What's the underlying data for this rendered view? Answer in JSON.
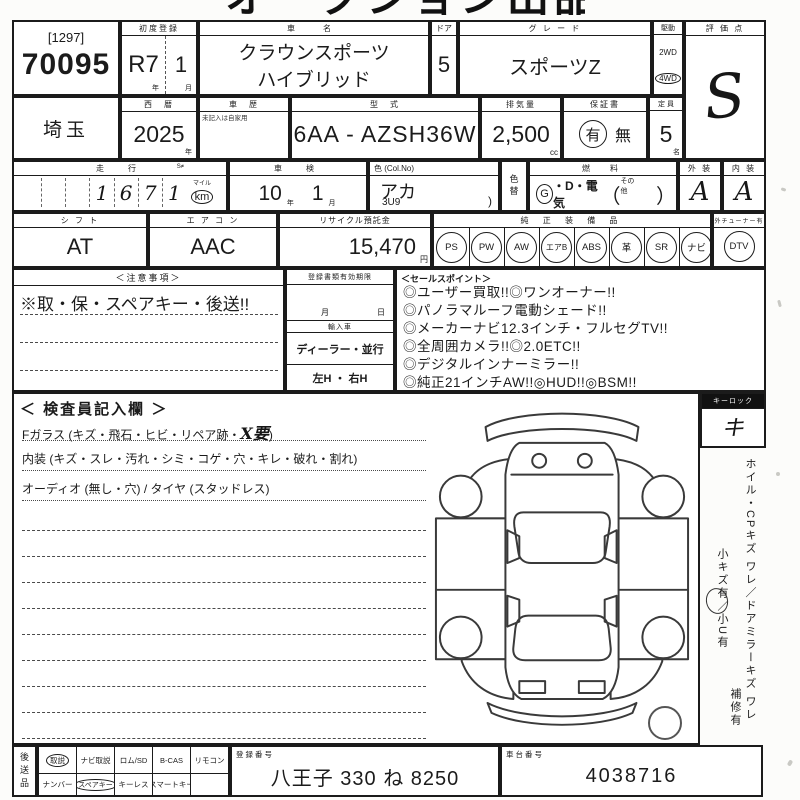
{
  "page": {
    "cropped_title": "オークション出品票"
  },
  "header": {
    "auction_bracket": "[1297]",
    "auction_no": "70095",
    "first_reg": {
      "label": "初度登録",
      "year": "R7",
      "year_suffix": "年",
      "month": "1",
      "month_suffix": "月"
    },
    "car_name": {
      "label": "車　名",
      "line1": "クラウンスポーツ",
      "line2": "ハイブリッド"
    },
    "door": {
      "label": "ドア",
      "value": "5"
    },
    "grade": {
      "label": "グ レ ー ド",
      "value": "スポーツZ"
    },
    "drive": {
      "label": "駆動",
      "opt_2wd": "2WD",
      "opt_4wd": "4WD",
      "selected": "4WD"
    },
    "score": {
      "label": "評 価 点",
      "value": "S"
    }
  },
  "row2": {
    "prefecture": "埼玉",
    "year": {
      "label": "西　暦",
      "value": "2025",
      "suffix": "年"
    },
    "history": {
      "label": "車　歴",
      "note": "未記入は自家用"
    },
    "model": {
      "label": "型　式",
      "value": "6AA - AZSH36W"
    },
    "displacement": {
      "label": "排気量",
      "value": "2,500",
      "suffix": "cc"
    },
    "warranty": {
      "label": "保証書",
      "yes": "有",
      "no": "無",
      "selected": "有"
    },
    "capacity": {
      "label": "定 員",
      "value": "5",
      "suffix": "名"
    }
  },
  "row3": {
    "mileage": {
      "label": "走　行",
      "small": "S≠",
      "d1": "1",
      "d2": "6",
      "d3": "7",
      "d4": "1",
      "unit_top": "マイル",
      "unit": "km",
      "unit_selected": "km"
    },
    "shaken": {
      "label": "車　検",
      "year": "10",
      "year_suffix": "年",
      "month": "1",
      "month_suffix": "月"
    },
    "color": {
      "label": "色 (Col.No)",
      "value": "アカ",
      "code": "3U9",
      "paren": ")"
    },
    "color_change": {
      "label": "色替"
    },
    "fuel": {
      "label": "燃　料",
      "g": "G",
      "rest": "・D・電気",
      "open": "（",
      "other": "その他",
      "close": "）",
      "selected": "G"
    },
    "exterior": {
      "label": "外 装",
      "value": "A"
    },
    "interior": {
      "label": "内 装",
      "value": "A"
    }
  },
  "row4": {
    "shift": {
      "label": "シ フ ト",
      "value": "AT"
    },
    "aircon": {
      "label": "エ ア コ ン",
      "value": "AAC"
    },
    "recycle": {
      "label": "リサイクル預託金",
      "value": "15,470",
      "suffix": "円"
    },
    "equipment": {
      "label": "純 正 装 備 品",
      "items": [
        "PS",
        "PW",
        "AW",
        "エアB",
        "ABS",
        "革",
        "SR",
        "ナビ"
      ],
      "extra_label": "外チューナー有",
      "extra": "DTV"
    }
  },
  "notes": {
    "label": "＜注意事項＞",
    "line1": "※取・保・スペアキー・後送!!"
  },
  "docs": {
    "validity": "登録書類有効期限",
    "month": "月",
    "day": "日",
    "import": "輸入車",
    "dealer": "ディーラー・並行",
    "handle": "左H ・ 右H"
  },
  "sales": {
    "label": "＜セールスポイント＞",
    "lines": [
      "◎ユーザー買取!!◎ワンオーナー!!",
      "◎パノラマルーフ電動シェード!!",
      "◎メーカーナビ12.3インチ・フルセグTV!!",
      "◎全周囲カメラ!!◎2.0ETC!!",
      "◎デジタルインナーミラー!!",
      "◎純正21インチAW!!◎HUD!!◎BSM!!"
    ]
  },
  "inspection": {
    "label": "＜ 検査員記入欄 ＞",
    "line1_pre": "Fガラス (キズ・飛石・ヒビ・リペア跡・",
    "line1_mark": "X要",
    "line1_post": ")",
    "line2": "内装 (キズ・スレ・汚れ・シミ・コゲ・穴・キレ・破れ・割れ)",
    "line3": "オーディオ (無し・穴) / タイヤ (スタッドレス)"
  },
  "side": {
    "keylock_label": "キーロック",
    "keylock_mark": "キ",
    "vert1": "ホイル・CPキズ ワレ／ドアミラーキズ ワレ",
    "vert2": "小キズ有／小U有",
    "vert3": "補修有"
  },
  "bottom": {
    "kousou": "後送品",
    "cells": {
      "r1c1": "取説",
      "r1c2": "ナビ取説",
      "r1c3": "ロム/SD",
      "r1c4": "B-CAS",
      "r1c5": "リモコン",
      "r2c1": "ナンバー",
      "r2c2": "スペアキー",
      "r2c3": "キーレス",
      "r2c4": "スマートキー",
      "r2c5": ""
    },
    "circled": [
      "取説",
      "スペアキー"
    ],
    "reg": {
      "label": "登録番号",
      "value": "八王子 330 ね 8250"
    },
    "chassis": {
      "label": "車台番号",
      "value": "4038716"
    }
  }
}
